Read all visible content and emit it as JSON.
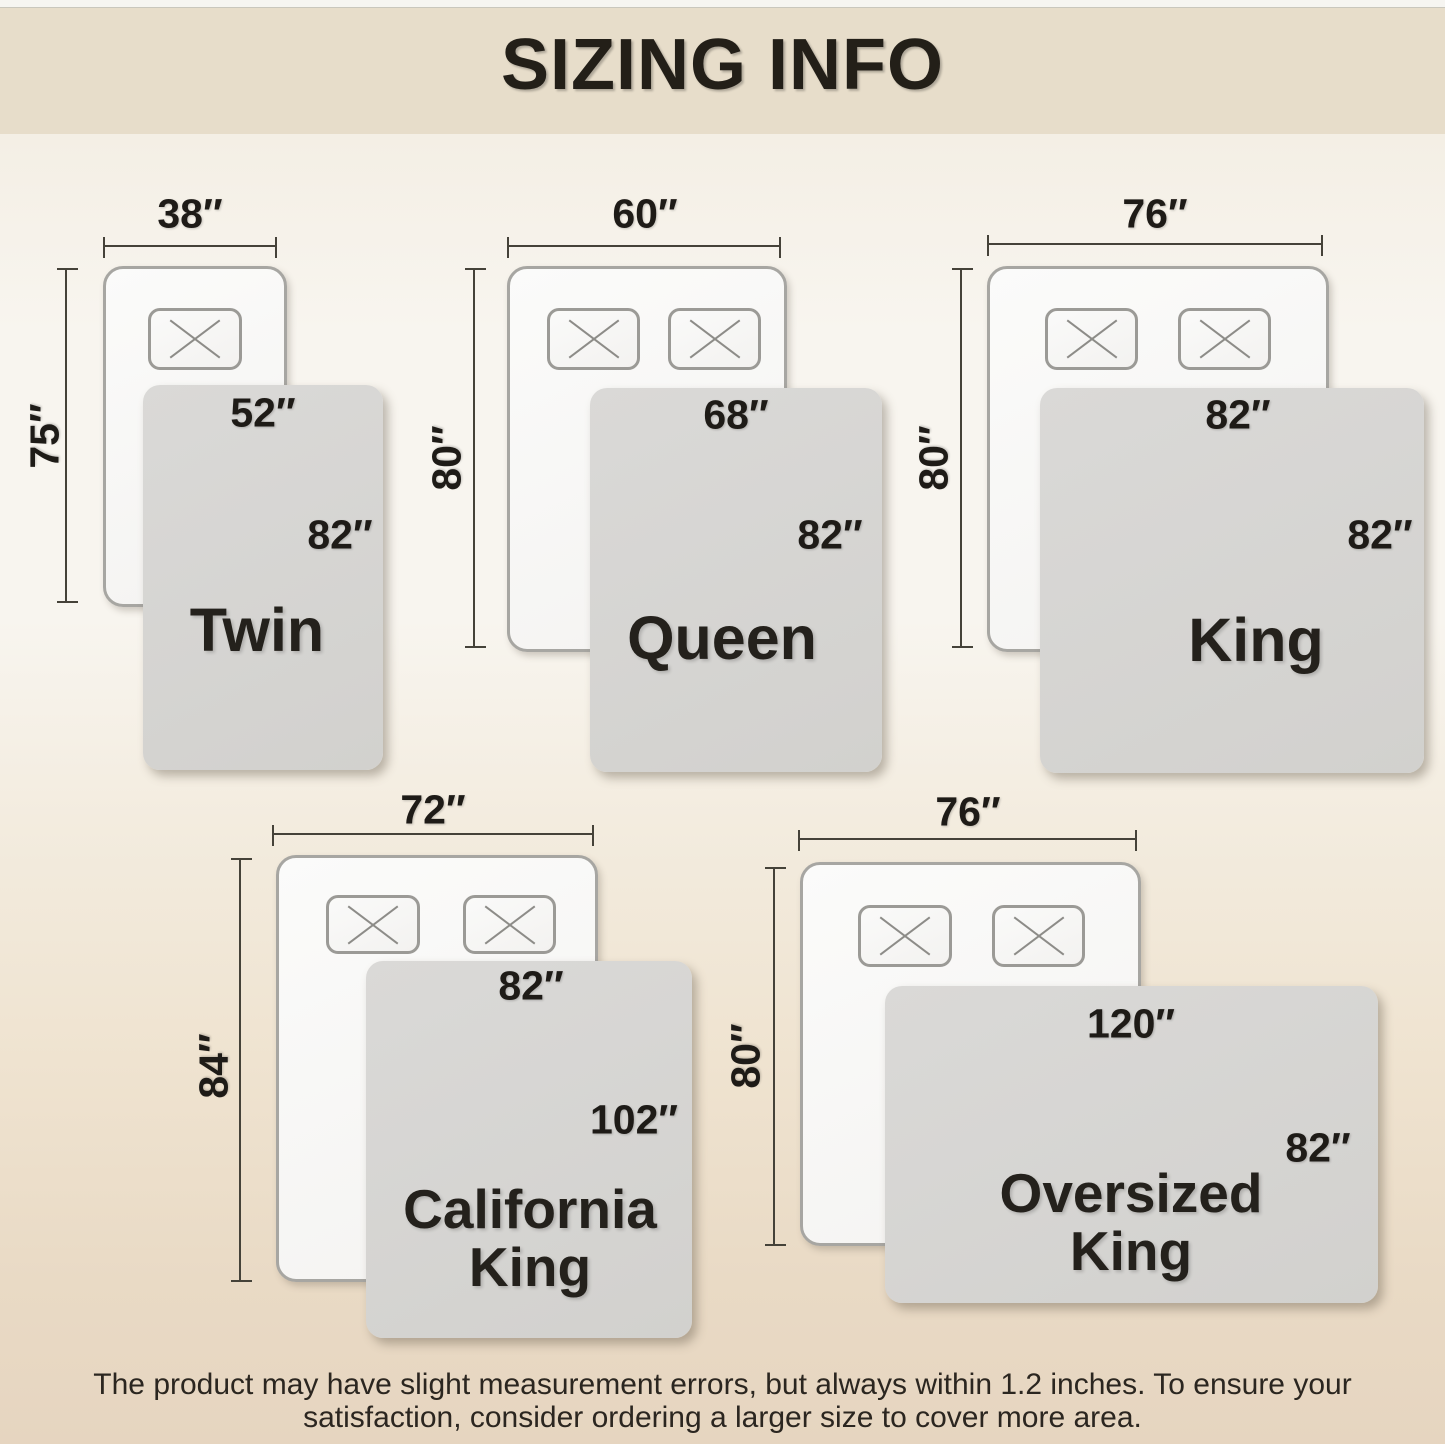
{
  "header": {
    "title": "SIZING INFO"
  },
  "beds": [
    {
      "name_line1": "Twin",
      "mattress_width": "38″",
      "mattress_length": "75″",
      "blanket_width": "52″",
      "blanket_length": "82″"
    },
    {
      "name_line1": "Queen",
      "mattress_width": "60″",
      "mattress_length": "80″",
      "blanket_width": "68″",
      "blanket_length": "82″"
    },
    {
      "name_line1": "King",
      "mattress_width": "76″",
      "mattress_length": "80″",
      "blanket_width": "82″",
      "blanket_length": "82″"
    },
    {
      "name_line1": "California",
      "name_line2": "King",
      "mattress_width": "72″",
      "mattress_length": "84″",
      "blanket_width": "82″",
      "blanket_length": "102″"
    },
    {
      "name_line1": "Oversized",
      "name_line2": "King",
      "mattress_width": "76″",
      "mattress_length": "80″",
      "blanket_width": "120″",
      "blanket_length": "82″"
    }
  ],
  "footer": {
    "line1": "The product may have slight measurement errors, but always within 1.2 inches. To ensure your",
    "line2": "satisfaction, consider ordering a larger size to cover more area."
  },
  "icons": {
    "pillow_cross_icon": "X"
  },
  "colors": {
    "header_bg": "#e7ddca",
    "page_bg_top": "#f2ece0",
    "page_bg_middle": "#f8f5ef",
    "page_bg_bottom": "#e6d5c0",
    "blanket_gray": "#d6d5d2",
    "mattress_white": "#f8f7f5",
    "dimension_line": "#454239",
    "text": "#1e1b17"
  }
}
